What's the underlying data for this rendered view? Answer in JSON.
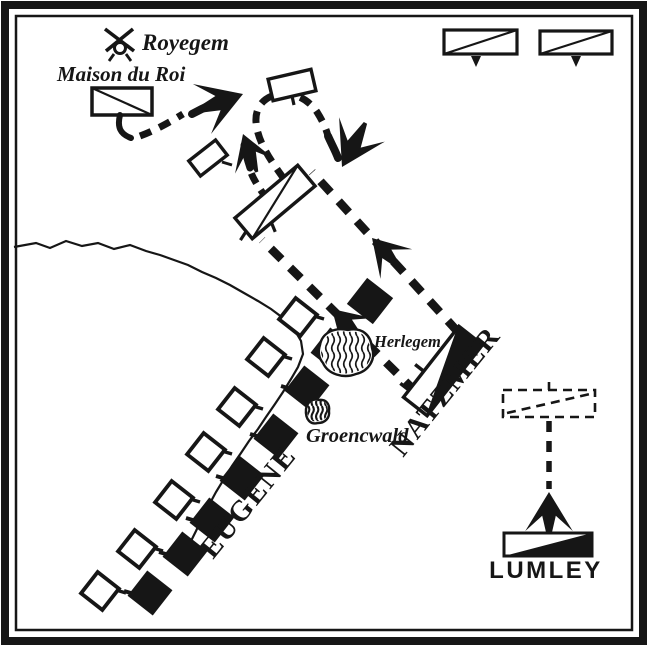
{
  "colors": {
    "ink": "#161616",
    "paper": "#ffffff"
  },
  "places": {
    "royegem": {
      "label": "Royegem"
    },
    "maison_du_roi": {
      "label": "Maison du Roi"
    },
    "herlegem": {
      "label": "Herlegem"
    },
    "groencwald": {
      "label": "Groencwald"
    }
  },
  "commanders": {
    "natzmer": {
      "label": "NATZMER"
    },
    "eugene": {
      "label": "EUGENE"
    },
    "lumley": {
      "label": "LUMLEY"
    }
  }
}
